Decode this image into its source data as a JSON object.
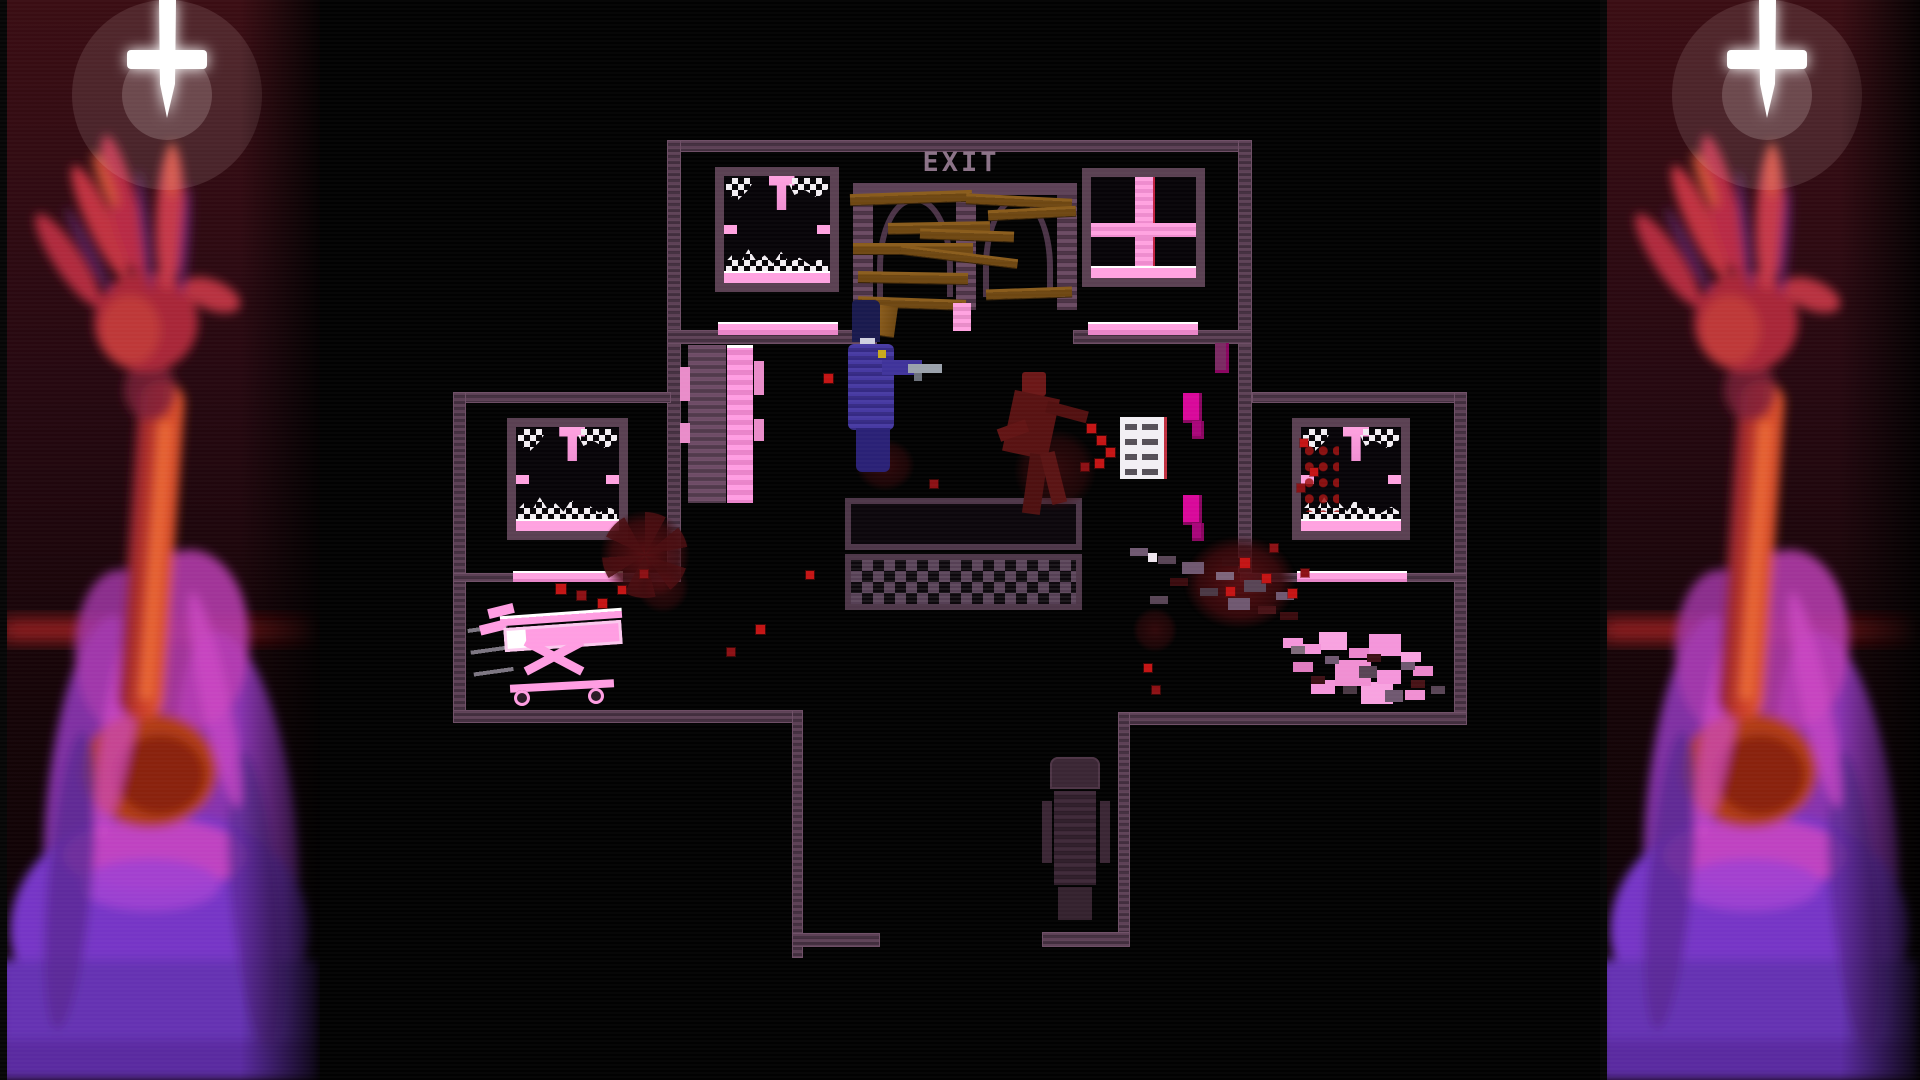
{
  "meta": {
    "description": "top-down pixel-art horror game scene flanked by painted side-art panels",
    "viewport": {
      "w": 1920,
      "h": 1080
    }
  },
  "labels": {
    "exit_sign": "EXIT"
  },
  "colors": {
    "wall": "#5d4156",
    "wallDark": "#422e3e",
    "sillPink": "#ffa2e0",
    "brightPink": "#ff9de2",
    "magenta": "#d8089a",
    "bloodBright": "#c41414",
    "bloodDark": "#3a0b0e",
    "plankBrown": "#6e4712",
    "playerBlue": "#473aa2",
    "gunGrey": "#9aa1ab",
    "exitText": "#8b7287",
    "panelRedTop": "#3a0d13",
    "crossWhite": "#ffffff",
    "hairPurple": "#9438c0",
    "armRed": "#c83a28"
  },
  "art_panels": {
    "left": {
      "motifs": [
        "inverted-cross-icon",
        "reaching-arm",
        "purple-haired-figure",
        "red-light-streak"
      ]
    },
    "right": {
      "motifs": [
        "inverted-cross-icon",
        "reaching-arm",
        "purple-haired-figure",
        "red-light-streak"
      ]
    }
  },
  "scene": [
    {
      "name": "top-room-top-wall",
      "cls": "wall",
      "x": 667,
      "y": 140,
      "w": 585,
      "h": 12
    },
    {
      "name": "building-left-wall",
      "cls": "wall",
      "x": 667,
      "y": 140,
      "w": 14,
      "h": 433
    },
    {
      "name": "building-right-wall",
      "cls": "wall",
      "x": 1238,
      "y": 140,
      "w": 14,
      "h": 433
    },
    {
      "name": "interior-wall-left",
      "cls": "wall",
      "x": 667,
      "y": 330,
      "w": 210,
      "h": 14
    },
    {
      "name": "interior-wall-right",
      "cls": "wall",
      "x": 1073,
      "y": 330,
      "w": 179,
      "h": 14
    },
    {
      "name": "left-wing-top-wall",
      "cls": "wall",
      "x": 453,
      "y": 392,
      "w": 218,
      "h": 11
    },
    {
      "name": "left-wing-left-wall",
      "cls": "wall",
      "x": 453,
      "y": 392,
      "w": 13,
      "h": 331
    },
    {
      "name": "left-wing-divider-wall",
      "cls": "wall",
      "x": 453,
      "y": 573,
      "w": 228,
      "h": 9
    },
    {
      "name": "right-wing-top-wall",
      "cls": "wall",
      "x": 1252,
      "y": 392,
      "w": 215,
      "h": 11
    },
    {
      "name": "right-wing-right-wall",
      "cls": "wall",
      "x": 1454,
      "y": 392,
      "w": 13,
      "h": 333
    },
    {
      "name": "right-wing-divider-wall",
      "cls": "wall",
      "x": 1240,
      "y": 573,
      "w": 227,
      "h": 9
    },
    {
      "name": "bottom-wall-left",
      "cls": "wall",
      "x": 453,
      "y": 710,
      "w": 350,
      "h": 13
    },
    {
      "name": "bottom-wall-right",
      "cls": "wall",
      "x": 1118,
      "y": 712,
      "w": 349,
      "h": 13
    },
    {
      "name": "corridor-left-wall",
      "cls": "wall",
      "x": 792,
      "y": 710,
      "w": 11,
      "h": 248
    },
    {
      "name": "corridor-right-wall",
      "cls": "wall",
      "x": 1118,
      "y": 712,
      "w": 12,
      "h": 235
    },
    {
      "name": "corridor-left-end-wall",
      "cls": "wall",
      "x": 792,
      "y": 933,
      "w": 88,
      "h": 14
    },
    {
      "name": "corridor-right-end-wall",
      "cls": "wall",
      "x": 1042,
      "y": 932,
      "w": 88,
      "h": 15
    },
    {
      "name": "interior-sill-left",
      "cls": "sill",
      "x": 718,
      "y": 322,
      "w": 120,
      "h": 13
    },
    {
      "name": "interior-sill-right",
      "cls": "sill",
      "x": 1088,
      "y": 322,
      "w": 110,
      "h": 13
    },
    {
      "name": "left-wing-sill",
      "cls": "sill",
      "x": 513,
      "y": 571,
      "w": 110,
      "h": 11
    },
    {
      "name": "right-wing-sill",
      "cls": "sill",
      "x": 1297,
      "y": 571,
      "w": 110,
      "h": 11
    },
    {
      "name": "window-top-left",
      "cls": "window",
      "x": 715,
      "y": 167,
      "w": 124,
      "h": 125,
      "parts": [
        {
          "name": "glass-shards-top-left",
          "cls": "shard tl"
        },
        {
          "name": "glass-shard-hanging",
          "cls": "shard hang"
        },
        {
          "name": "glass-shards-top-right",
          "cls": "shard tr"
        },
        {
          "name": "ledge-left",
          "cls": "notch l"
        },
        {
          "name": "ledge-right",
          "cls": "notch r"
        },
        {
          "name": "glass-shards-bottom",
          "cls": "shard pile"
        },
        {
          "name": "window-sill",
          "cls": "wsill"
        }
      ]
    },
    {
      "name": "window-top-right",
      "cls": "window",
      "x": 1082,
      "y": 168,
      "w": 123,
      "h": 119,
      "parts": [
        {
          "name": "window-cross-vertical",
          "cls": "xbar v"
        },
        {
          "name": "window-cross-horizontal",
          "cls": "xbar h"
        },
        {
          "name": "window-sill",
          "cls": "wsill"
        }
      ]
    },
    {
      "name": "window-left-wing",
      "cls": "window",
      "x": 507,
      "y": 418,
      "w": 121,
      "h": 122,
      "parts": [
        {
          "name": "glass-shards-top-left",
          "cls": "shard tl"
        },
        {
          "name": "glass-shard-hanging",
          "cls": "shard hang"
        },
        {
          "name": "glass-shards-top-right",
          "cls": "shard tr"
        },
        {
          "name": "ledge-left",
          "cls": "notch l"
        },
        {
          "name": "ledge-right",
          "cls": "notch r"
        },
        {
          "name": "glass-shards-bottom",
          "cls": "shard pile"
        },
        {
          "name": "window-sill",
          "cls": "wsill"
        }
      ]
    },
    {
      "name": "window-right-wing",
      "cls": "window",
      "x": 1292,
      "y": 418,
      "w": 118,
      "h": 122,
      "parts": [
        {
          "name": "glass-shards-top-left",
          "cls": "shard tl"
        },
        {
          "name": "glass-shard-hanging",
          "cls": "shard hang"
        },
        {
          "name": "glass-shards-top-right",
          "cls": "shard tr"
        },
        {
          "name": "ledge-left",
          "cls": "notch l"
        },
        {
          "name": "ledge-right",
          "cls": "notch r"
        },
        {
          "name": "glass-shards-bottom",
          "cls": "shard pile"
        },
        {
          "name": "blood-specks",
          "cls": "blood-specks"
        },
        {
          "name": "window-sill",
          "cls": "wsill"
        }
      ]
    },
    {
      "name": "barricade-frame",
      "cls": "barricade",
      "x": 853,
      "y": 183,
      "w": 224,
      "h": 127,
      "parts": [
        {
          "name": "frame-post-left",
          "cls": "post p1"
        },
        {
          "name": "frame-post-middle",
          "cls": "post p2"
        },
        {
          "name": "frame-post-right",
          "cls": "post p3"
        },
        {
          "name": "frame-top-beam",
          "cls": "beam"
        },
        {
          "name": "arch-left",
          "cls": "arch a1"
        },
        {
          "name": "arch-right",
          "cls": "arch a2"
        }
      ]
    },
    {
      "name": "plank",
      "cls": "plank",
      "x": 850,
      "y": 192,
      "w": 122,
      "h": 11,
      "rot": -2
    },
    {
      "name": "plank",
      "cls": "plank",
      "x": 966,
      "y": 196,
      "w": 106,
      "h": 10,
      "rot": 3
    },
    {
      "name": "plank",
      "cls": "plank",
      "x": 888,
      "y": 222,
      "w": 102,
      "h": 11,
      "rot": -1
    },
    {
      "name": "plank",
      "cls": "plank",
      "x": 920,
      "y": 230,
      "w": 94,
      "h": 10,
      "rot": 2
    },
    {
      "name": "plank",
      "cls": "plank",
      "x": 853,
      "y": 243,
      "w": 120,
      "h": 11,
      "rot": 0
    },
    {
      "name": "plank",
      "cls": "plank",
      "x": 988,
      "y": 208,
      "w": 88,
      "h": 10,
      "rot": -3
    },
    {
      "name": "plank",
      "cls": "plank",
      "x": 900,
      "y": 252,
      "w": 118,
      "h": 9,
      "rot": 7
    },
    {
      "name": "plank",
      "cls": "plank",
      "x": 858,
      "y": 272,
      "w": 110,
      "h": 11,
      "rot": 1
    },
    {
      "name": "plank",
      "cls": "plank",
      "x": 986,
      "y": 288,
      "w": 86,
      "h": 10,
      "rot": -2
    },
    {
      "name": "plank",
      "cls": "plank",
      "x": 858,
      "y": 298,
      "w": 108,
      "h": 10,
      "rot": 2
    },
    {
      "name": "plank-fragment",
      "cls": "plank vert",
      "x": 878,
      "y": 306,
      "w": 18,
      "h": 30,
      "rot": 8
    },
    {
      "name": "door-jamb",
      "cls": "jamb",
      "x": 953,
      "y": 303,
      "w": 18,
      "h": 28
    },
    {
      "name": "pink-locker",
      "cls": "locker",
      "x": 688,
      "y": 345,
      "w": 68,
      "h": 158,
      "parts": [
        {
          "name": "locker-body",
          "cls": "lk-body"
        },
        {
          "name": "locker-panel",
          "cls": "lk-panel"
        },
        {
          "name": "locker-tab-left-top",
          "cls": "lk-tab lt"
        },
        {
          "name": "locker-tab-left-bottom",
          "cls": "lk-tab lb"
        },
        {
          "name": "locker-tab-right-top",
          "cls": "lk-tab rt"
        },
        {
          "name": "locker-tab-right-bottom",
          "cls": "lk-tab rb"
        }
      ]
    },
    {
      "name": "reception-desk",
      "cls": "table",
      "x": 845,
      "y": 498,
      "w": 237,
      "h": 112,
      "parts": [
        {
          "name": "desk-top",
          "cls": "t-top"
        },
        {
          "name": "desk-checker-front",
          "cls": "t-checker"
        }
      ]
    },
    {
      "name": "notice-panel",
      "cls": "notice",
      "x": 1120,
      "y": 417,
      "w": 44,
      "h": 62
    },
    {
      "name": "wall-fixture-top",
      "cls": "magenta-box",
      "x": 1183,
      "y": 393,
      "w": 19,
      "h": 30
    },
    {
      "name": "wall-fixture-top-tab",
      "cls": "magenta-box dark",
      "x": 1192,
      "y": 421,
      "w": 12,
      "h": 18
    },
    {
      "name": "wall-fixture-bottom",
      "cls": "magenta-box",
      "x": 1183,
      "y": 495,
      "w": 19,
      "h": 30
    },
    {
      "name": "wall-fixture-bottom-tab",
      "cls": "magenta-box dark",
      "x": 1192,
      "y": 523,
      "w": 12,
      "h": 18
    },
    {
      "name": "wall-fixture-upper",
      "cls": "magenta-box darker",
      "x": 1215,
      "y": 343,
      "w": 14,
      "h": 30
    },
    {
      "name": "office-chair",
      "cls": "chair",
      "x": 1042,
      "y": 757,
      "w": 68,
      "h": 163,
      "parts": [
        {
          "name": "chair-back",
          "cls": "ch-back"
        },
        {
          "name": "chair-body",
          "cls": "ch-body"
        },
        {
          "name": "chair-arm-left",
          "cls": "ch-arm-l"
        },
        {
          "name": "chair-arm-right",
          "cls": "ch-arm-r"
        },
        {
          "name": "chair-base",
          "cls": "ch-base"
        }
      ]
    },
    {
      "name": "blood-pool-hall-left",
      "cls": "blood-pool spokes",
      "x": 585,
      "y": 495,
      "w": 120,
      "h": 120
    },
    {
      "name": "blood-pool-right",
      "cls": "blood-pool big",
      "x": 1165,
      "y": 520,
      "w": 150,
      "h": 125
    },
    {
      "name": "blood-smear-under-corpse",
      "cls": "blood-pool faint",
      "x": 1000,
      "y": 415,
      "w": 110,
      "h": 110
    },
    {
      "name": "blood-smear-under-player",
      "cls": "blood-pool faint",
      "x": 845,
      "y": 430,
      "w": 80,
      "h": 70
    },
    {
      "name": "blood-smear-left-wing",
      "cls": "blood-pool faint",
      "x": 628,
      "y": 552,
      "w": 70,
      "h": 70
    },
    {
      "name": "blood-smear-corridor",
      "cls": "blood-pool faint",
      "x": 1125,
      "y": 600,
      "w": 60,
      "h": 60
    },
    {
      "name": "debris-trail",
      "cls": "debris",
      "x": 1130,
      "y": 548,
      "w": 180,
      "h": 95
    },
    {
      "name": "wrecked-gurney",
      "cls": "wreck",
      "x": 1283,
      "y": 638,
      "w": 162,
      "h": 78
    },
    {
      "name": "blood-dot",
      "cls": "dot",
      "x": 824,
      "y": 374,
      "w": 9,
      "h": 9
    },
    {
      "name": "blood-dot",
      "cls": "dot",
      "x": 806,
      "y": 571,
      "w": 8,
      "h": 8
    },
    {
      "name": "blood-dot",
      "cls": "dot",
      "x": 756,
      "y": 625,
      "w": 9,
      "h": 9
    },
    {
      "name": "blood-dot",
      "cls": "dot dim",
      "x": 727,
      "y": 648,
      "w": 8,
      "h": 8
    },
    {
      "name": "blood-dot",
      "cls": "dot",
      "x": 556,
      "y": 584,
      "w": 10,
      "h": 10
    },
    {
      "name": "blood-dot",
      "cls": "dot dim",
      "x": 577,
      "y": 591,
      "w": 9,
      "h": 9
    },
    {
      "name": "blood-dot",
      "cls": "dot",
      "x": 598,
      "y": 599,
      "w": 9,
      "h": 9
    },
    {
      "name": "blood-dot",
      "cls": "dot",
      "x": 618,
      "y": 586,
      "w": 8,
      "h": 8
    },
    {
      "name": "blood-dot",
      "cls": "dot dim",
      "x": 640,
      "y": 570,
      "w": 8,
      "h": 8
    },
    {
      "name": "blood-dot",
      "cls": "dot",
      "x": 1087,
      "y": 424,
      "w": 9,
      "h": 9
    },
    {
      "name": "blood-dot",
      "cls": "dot",
      "x": 1097,
      "y": 436,
      "w": 9,
      "h": 9
    },
    {
      "name": "blood-dot",
      "cls": "dot",
      "x": 1106,
      "y": 448,
      "w": 9,
      "h": 9
    },
    {
      "name": "blood-dot",
      "cls": "dot",
      "x": 1095,
      "y": 459,
      "w": 9,
      "h": 9
    },
    {
      "name": "blood-dot",
      "cls": "dot dim",
      "x": 1081,
      "y": 463,
      "w": 8,
      "h": 8
    },
    {
      "name": "blood-dot",
      "cls": "dot",
      "x": 1240,
      "y": 558,
      "w": 10,
      "h": 10
    },
    {
      "name": "blood-dot",
      "cls": "dot",
      "x": 1262,
      "y": 574,
      "w": 9,
      "h": 9
    },
    {
      "name": "blood-dot",
      "cls": "dot",
      "x": 1288,
      "y": 589,
      "w": 9,
      "h": 9
    },
    {
      "name": "blood-dot",
      "cls": "dot dim",
      "x": 1270,
      "y": 544,
      "w": 8,
      "h": 8
    },
    {
      "name": "blood-dot",
      "cls": "dot",
      "x": 1226,
      "y": 587,
      "w": 9,
      "h": 9
    },
    {
      "name": "blood-dot",
      "cls": "dot dim",
      "x": 1301,
      "y": 569,
      "w": 8,
      "h": 8
    },
    {
      "name": "blood-dot",
      "cls": "dot",
      "x": 1144,
      "y": 664,
      "w": 8,
      "h": 8
    },
    {
      "name": "blood-dot",
      "cls": "dot dim",
      "x": 1152,
      "y": 686,
      "w": 8,
      "h": 8
    },
    {
      "name": "blood-dot",
      "cls": "dot",
      "x": 1300,
      "y": 439,
      "w": 8,
      "h": 8
    },
    {
      "name": "blood-dot",
      "cls": "dot",
      "x": 1310,
      "y": 468,
      "w": 8,
      "h": 8
    },
    {
      "name": "blood-dot",
      "cls": "dot dim",
      "x": 1297,
      "y": 484,
      "w": 8,
      "h": 8
    },
    {
      "name": "blood-dot",
      "cls": "dot dim",
      "x": 930,
      "y": 480,
      "w": 8,
      "h": 8
    },
    {
      "name": "glass-speck",
      "cls": "dot white",
      "x": 1148,
      "y": 553,
      "w": 9,
      "h": 9
    },
    {
      "name": "gurney",
      "cls": "gurney",
      "x": 470,
      "y": 598,
      "w": 170,
      "h": 110,
      "parts": [
        {
          "name": "scuff-streaks",
          "cls": "g-streaks"
        },
        {
          "name": "gurney-handle",
          "cls": "g-handle"
        },
        {
          "name": "gurney-rail-top",
          "cls": "g-rail-top"
        },
        {
          "name": "gurney-mattress",
          "cls": "g-mattress"
        },
        {
          "name": "gurney-leg-cross-1",
          "cls": "g-legs-x1"
        },
        {
          "name": "gurney-leg-cross-2",
          "cls": "g-legs-x2"
        },
        {
          "name": "gurney-rail-bottom",
          "cls": "g-rail-bottom"
        },
        {
          "name": "gurney-wheel-left",
          "cls": "g-wheel w1"
        },
        {
          "name": "gurney-wheel-right",
          "cls": "g-wheel w2"
        }
      ]
    },
    {
      "name": "corpse",
      "cls": "corpse",
      "x": 998,
      "y": 372,
      "w": 92,
      "h": 145,
      "parts": [
        {
          "name": "corpse-head",
          "cls": "c-head"
        },
        {
          "name": "corpse-torso",
          "cls": "c-torso"
        },
        {
          "name": "corpse-arm-left",
          "cls": "c-arm1"
        },
        {
          "name": "corpse-arm-right",
          "cls": "c-arm2"
        },
        {
          "name": "corpse-leg-left",
          "cls": "c-leg1"
        },
        {
          "name": "corpse-leg-right",
          "cls": "c-leg2"
        }
      ]
    },
    {
      "name": "player-character",
      "cls": "player",
      "x": 846,
      "y": 300,
      "w": 96,
      "h": 172,
      "parts": [
        {
          "name": "player-hair",
          "cls": "p-hair"
        },
        {
          "name": "player-face",
          "cls": "p-face"
        },
        {
          "name": "player-torso",
          "cls": "p-torso"
        },
        {
          "name": "player-badge",
          "cls": "p-badge"
        },
        {
          "name": "player-arm",
          "cls": "p-arm"
        },
        {
          "name": "player-gun",
          "cls": "p-gun"
        },
        {
          "name": "player-legs",
          "cls": "p-legs"
        }
      ]
    },
    {
      "name": "exit-sign",
      "cls": "exit-sign",
      "x": 916,
      "y": 148,
      "w": 90,
      "h": 32,
      "bind": "labels.exit_sign"
    }
  ]
}
